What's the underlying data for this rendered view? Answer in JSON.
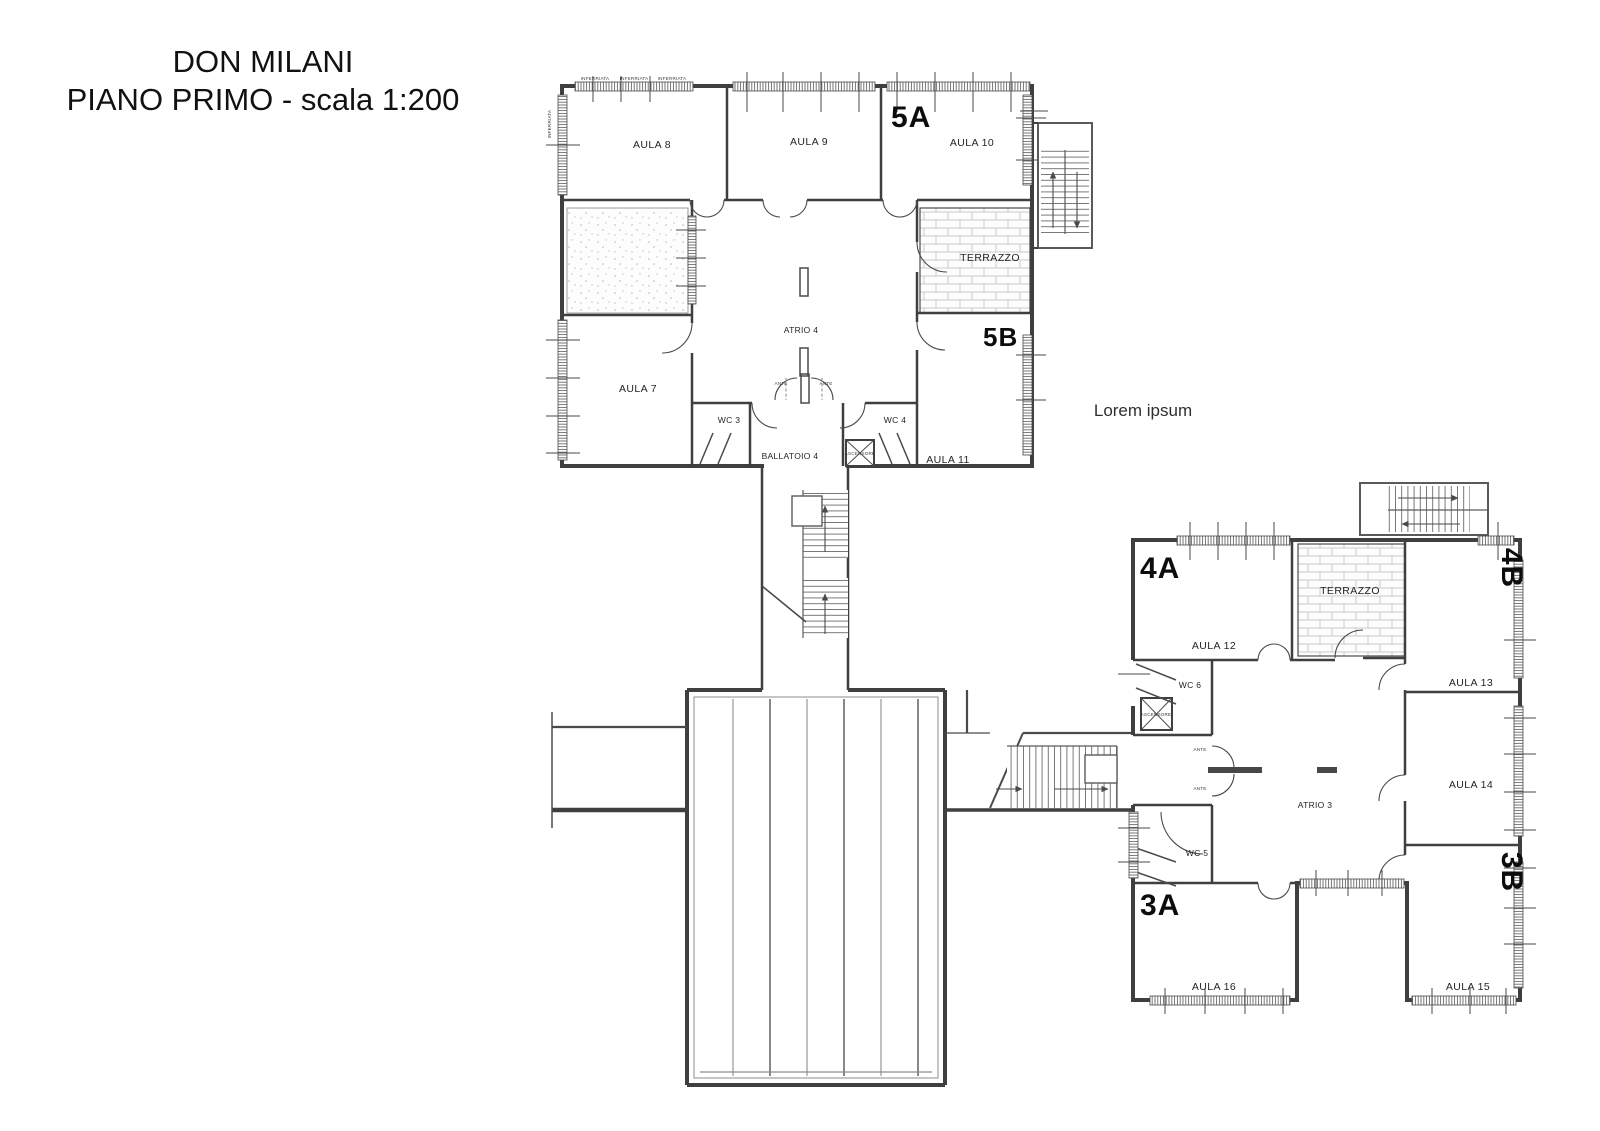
{
  "title": {
    "line1": "DON MILANI",
    "line2": "PIANO PRIMO - scala 1:200"
  },
  "annotation": "Lorem ipsum",
  "upper_block": {
    "section_a": "5A",
    "section_b": "5B",
    "aula7": "AULA 7",
    "aula8": "AULA 8",
    "aula9": "AULA 9",
    "aula10": "AULA 10",
    "aula11": "AULA 11",
    "wc3": "WC 3",
    "wc4": "WC 4",
    "ballatoio": "BALLATOIO 4",
    "atrio": "ATRIO 4",
    "terrazzo": "TERRAZZO",
    "ascensore": "ASCENSORE",
    "inferriata": "INFERRIATA",
    "ante": "ANTE"
  },
  "lower_block": {
    "section_4a": "4A",
    "section_4b": "4B",
    "section_3a": "3A",
    "section_3b": "3B",
    "aula12": "AULA 12",
    "aula13": "AULA 13",
    "aula14": "AULA 14",
    "aula15": "AULA 15",
    "aula16": "AULA 16",
    "wc5": "WC 5",
    "wc6": "WC 6",
    "atrio": "ATRIO 3",
    "terrazzo": "TERRAZZO",
    "ascensore": "ASCENSORE",
    "ante": "ANTE"
  },
  "colors": {
    "wall": "#3f3f3f",
    "background": "#ffffff",
    "text": "#1f1f1f"
  }
}
